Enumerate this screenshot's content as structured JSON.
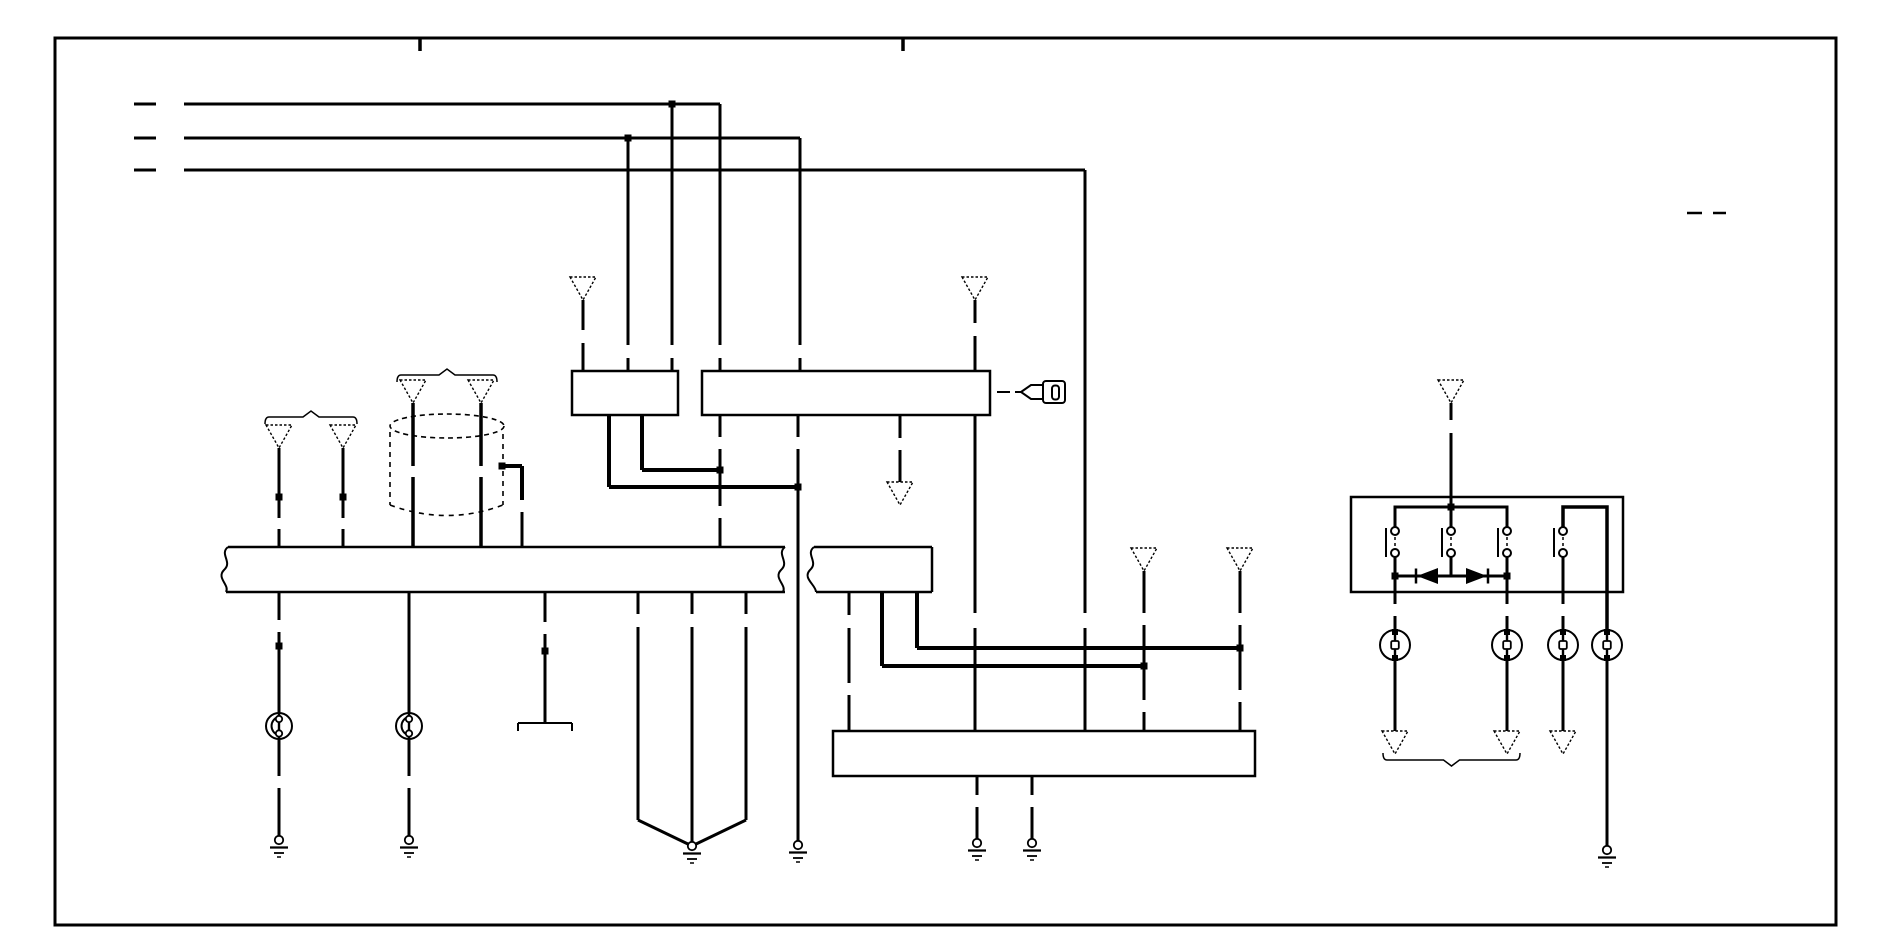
{
  "figure": {
    "kind": "automotive-wiring-diagram",
    "canvas": {
      "width": 1900,
      "height": 950
    },
    "colors": {
      "ink": "#000000",
      "paper": "#ffffff"
    },
    "border": {
      "x": 55,
      "y": 38,
      "w": 1781,
      "h": 887,
      "stroke": 3
    },
    "elements": [
      {
        "t": "l",
        "nm": "fold-tick",
        "x1": 420,
        "y1": 38,
        "x2": 420,
        "y2": 51,
        "w": 3.5
      },
      {
        "t": "l",
        "nm": "fold-tick",
        "x1": 903,
        "y1": 38,
        "x2": 903,
        "y2": 51,
        "w": 3.5
      },
      {
        "t": "l",
        "nm": "dash-mark",
        "x1": 1687,
        "y1": 213,
        "x2": 1702,
        "y2": 213,
        "w": 2.5
      },
      {
        "t": "l",
        "nm": "dash-mark",
        "x1": 1713,
        "y1": 213,
        "x2": 1726,
        "y2": 213,
        "w": 2.5
      },
      {
        "t": "l",
        "nm": "bus-1-lead",
        "x1": 134,
        "y1": 104,
        "x2": 156,
        "y2": 104
      },
      {
        "t": "l",
        "nm": "bus-1",
        "x1": 184,
        "y1": 104,
        "x2": 720,
        "y2": 104
      },
      {
        "t": "l",
        "x1": 720,
        "y1": 104,
        "x2": 720,
        "y2": 345
      },
      {
        "t": "l",
        "x1": 720,
        "y1": 358,
        "x2": 720,
        "y2": 371
      },
      {
        "t": "dot",
        "x": 672,
        "y": 104
      },
      {
        "t": "l",
        "x1": 672,
        "y1": 104,
        "x2": 672,
        "y2": 345
      },
      {
        "t": "l",
        "x1": 672,
        "y1": 358,
        "x2": 672,
        "y2": 371
      },
      {
        "t": "l",
        "nm": "bus-2-lead",
        "x1": 134,
        "y1": 138,
        "x2": 156,
        "y2": 138
      },
      {
        "t": "l",
        "nm": "bus-2",
        "x1": 184,
        "y1": 138,
        "x2": 800,
        "y2": 138
      },
      {
        "t": "l",
        "x1": 800,
        "y1": 138,
        "x2": 800,
        "y2": 345
      },
      {
        "t": "l",
        "x1": 800,
        "y1": 358,
        "x2": 800,
        "y2": 371
      },
      {
        "t": "dot",
        "x": 628,
        "y": 138
      },
      {
        "t": "l",
        "x1": 628,
        "y1": 138,
        "x2": 628,
        "y2": 345
      },
      {
        "t": "l",
        "x1": 628,
        "y1": 358,
        "x2": 628,
        "y2": 371
      },
      {
        "t": "l",
        "nm": "bus-3-lead",
        "x1": 134,
        "y1": 170,
        "x2": 156,
        "y2": 170
      },
      {
        "t": "l",
        "nm": "bus-3",
        "x1": 184,
        "y1": 170,
        "x2": 1085,
        "y2": 170
      },
      {
        "t": "l",
        "x1": 1085,
        "y1": 170,
        "x2": 1085,
        "y2": 613
      },
      {
        "t": "l",
        "x1": 1085,
        "y1": 628,
        "x2": 1085,
        "y2": 731
      },
      {
        "t": "tri",
        "x": 583,
        "y": 277
      },
      {
        "t": "l",
        "x1": 583,
        "y1": 300,
        "x2": 583,
        "y2": 330
      },
      {
        "t": "l",
        "x1": 583,
        "y1": 343,
        "x2": 583,
        "y2": 371
      },
      {
        "t": "tri",
        "x": 975,
        "y": 277
      },
      {
        "t": "l",
        "x1": 975,
        "y1": 300,
        "x2": 975,
        "y2": 323
      },
      {
        "t": "l",
        "x1": 975,
        "y1": 336,
        "x2": 975,
        "y2": 371
      },
      {
        "t": "rect",
        "nm": "component-box-a",
        "x": 572,
        "y": 371,
        "w": 106,
        "h": 44
      },
      {
        "t": "rect",
        "nm": "component-box-b",
        "x": 702,
        "y": 371,
        "w": 288,
        "h": 44
      },
      {
        "t": "l",
        "x1": 642,
        "y1": 415,
        "x2": 642,
        "y2": 470,
        "w": 4
      },
      {
        "t": "l",
        "x1": 642,
        "y1": 470,
        "x2": 720,
        "y2": 470,
        "w": 4
      },
      {
        "t": "dot",
        "x": 720,
        "y": 470
      },
      {
        "t": "l",
        "x1": 609,
        "y1": 415,
        "x2": 609,
        "y2": 487,
        "w": 4
      },
      {
        "t": "l",
        "x1": 609,
        "y1": 487,
        "x2": 798,
        "y2": 487,
        "w": 4
      },
      {
        "t": "dot",
        "x": 798,
        "y": 487
      },
      {
        "t": "l",
        "x1": 720,
        "y1": 415,
        "x2": 720,
        "y2": 437
      },
      {
        "t": "l",
        "x1": 720,
        "y1": 449,
        "x2": 720,
        "y2": 470
      },
      {
        "t": "l",
        "x1": 720,
        "y1": 470,
        "x2": 720,
        "y2": 506
      },
      {
        "t": "l",
        "x1": 720,
        "y1": 518,
        "x2": 720,
        "y2": 547
      },
      {
        "t": "l",
        "x1": 798,
        "y1": 415,
        "x2": 798,
        "y2": 437
      },
      {
        "t": "l",
        "x1": 798,
        "y1": 449,
        "x2": 798,
        "y2": 487
      },
      {
        "t": "l",
        "x1": 798,
        "y1": 487,
        "x2": 798,
        "y2": 841
      },
      {
        "t": "gnd",
        "x": 798,
        "y": 845
      },
      {
        "t": "l",
        "x1": 900,
        "y1": 415,
        "x2": 900,
        "y2": 438
      },
      {
        "t": "l",
        "x1": 900,
        "y1": 450,
        "x2": 900,
        "y2": 482
      },
      {
        "t": "tri",
        "x": 900,
        "y": 482
      },
      {
        "t": "l",
        "x1": 975,
        "y1": 415,
        "x2": 975,
        "y2": 613
      },
      {
        "t": "l",
        "x1": 975,
        "y1": 628,
        "x2": 975,
        "y2": 731
      },
      {
        "t": "key",
        "nm": "ignition-key-icon",
        "x": 997,
        "y": 392
      },
      {
        "t": "ell",
        "nm": "coil-ring",
        "x": 447,
        "y": 426,
        "rx": 57,
        "ry": 12
      },
      {
        "t": "l",
        "nm": "cylinder-side",
        "x1": 390,
        "y1": 432,
        "x2": 390,
        "y2": 505,
        "w": 1.6,
        "d": "5,5"
      },
      {
        "t": "l",
        "nm": "cylinder-side",
        "x1": 503,
        "y1": 434,
        "x2": 503,
        "y2": 461,
        "w": 1.6,
        "d": "5,5"
      },
      {
        "t": "l",
        "nm": "cylinder-side",
        "x1": 503,
        "y1": 471,
        "x2": 503,
        "y2": 505,
        "w": 1.6,
        "d": "5,5"
      },
      {
        "t": "p",
        "nm": "cylinder-bottom",
        "d": "M390,505 Q447,526 503,505",
        "w": 1.6,
        "dash": "5,5"
      },
      {
        "t": "dot",
        "x": 502,
        "y": 466
      },
      {
        "t": "l",
        "x1": 502,
        "y1": 466,
        "x2": 522,
        "y2": 466,
        "w": 4
      },
      {
        "t": "l",
        "x1": 522,
        "y1": 466,
        "x2": 522,
        "y2": 500,
        "w": 4
      },
      {
        "t": "l",
        "x1": 522,
        "y1": 512,
        "x2": 522,
        "y2": 547
      },
      {
        "t": "tri",
        "x": 413,
        "y": 380
      },
      {
        "t": "l",
        "x1": 413,
        "y1": 403,
        "x2": 413,
        "y2": 466,
        "w": 3.5
      },
      {
        "t": "l",
        "x1": 413,
        "y1": 477,
        "x2": 413,
        "y2": 547,
        "w": 3.5
      },
      {
        "t": "tri",
        "x": 481,
        "y": 380
      },
      {
        "t": "l",
        "x1": 481,
        "y1": 403,
        "x2": 481,
        "y2": 466,
        "w": 3.5
      },
      {
        "t": "l",
        "x1": 481,
        "y1": 477,
        "x2": 481,
        "y2": 547,
        "w": 3.5
      },
      {
        "t": "brace",
        "x1": 397,
        "x2": 497,
        "y": 375,
        "dir": "up"
      },
      {
        "t": "tri",
        "x": 279,
        "y": 425
      },
      {
        "t": "l",
        "x1": 279,
        "y1": 448,
        "x2": 279,
        "y2": 518
      },
      {
        "t": "dot",
        "x": 279,
        "y": 497
      },
      {
        "t": "l",
        "x1": 279,
        "y1": 529,
        "x2": 279,
        "y2": 547
      },
      {
        "t": "tri",
        "x": 343,
        "y": 425
      },
      {
        "t": "l",
        "x1": 343,
        "y1": 448,
        "x2": 343,
        "y2": 518
      },
      {
        "t": "dot",
        "x": 343,
        "y": 497
      },
      {
        "t": "l",
        "x1": 343,
        "y1": 529,
        "x2": 343,
        "y2": 547
      },
      {
        "t": "brace",
        "x1": 265,
        "x2": 357,
        "y": 417,
        "dir": "up"
      },
      {
        "t": "l",
        "nm": "bar-a-top",
        "x1": 228,
        "y1": 547,
        "x2": 785,
        "y2": 547,
        "w": 2.5
      },
      {
        "t": "l",
        "nm": "bar-a-bottom",
        "x1": 226,
        "y1": 592,
        "x2": 785,
        "y2": 592,
        "w": 2.5
      },
      {
        "t": "p",
        "nm": "bar-a-torn-left",
        "d": "M228,547 C219,554 233,562 224,570 C216,578 230,585 226,592",
        "w": 2
      },
      {
        "t": "p",
        "nm": "bar-a-torn-right",
        "d": "M785,547 C776,554 790,562 781,570 C773,578 787,585 783,592",
        "w": 2
      },
      {
        "t": "l",
        "x1": 279,
        "y1": 592,
        "x2": 279,
        "y2": 620
      },
      {
        "t": "l",
        "x1": 279,
        "y1": 632,
        "x2": 279,
        "y2": 713
      },
      {
        "t": "dot",
        "x": 279,
        "y": 646
      },
      {
        "t": "ca",
        "x": 279,
        "y": 726
      },
      {
        "t": "l",
        "x1": 279,
        "y1": 739,
        "x2": 279,
        "y2": 776
      },
      {
        "t": "l",
        "x1": 279,
        "y1": 788,
        "x2": 279,
        "y2": 836
      },
      {
        "t": "gnd",
        "x": 279,
        "y": 840
      },
      {
        "t": "l",
        "x1": 409,
        "y1": 592,
        "x2": 409,
        "y2": 713
      },
      {
        "t": "ca",
        "x": 409,
        "y": 726
      },
      {
        "t": "l",
        "x1": 409,
        "y1": 739,
        "x2": 409,
        "y2": 776
      },
      {
        "t": "l",
        "x1": 409,
        "y1": 788,
        "x2": 409,
        "y2": 836
      },
      {
        "t": "gnd",
        "x": 409,
        "y": 840
      },
      {
        "t": "l",
        "x1": 545,
        "y1": 592,
        "x2": 545,
        "y2": 622
      },
      {
        "t": "l",
        "x1": 545,
        "y1": 634,
        "x2": 545,
        "y2": 723
      },
      {
        "t": "dot",
        "x": 545,
        "y": 651
      },
      {
        "t": "l",
        "nm": "bracket-bar",
        "x1": 518,
        "y1": 723,
        "x2": 572,
        "y2": 723,
        "w": 2
      },
      {
        "t": "l",
        "nm": "bracket-tick",
        "x1": 518,
        "y1": 723,
        "x2": 518,
        "y2": 731,
        "w": 2
      },
      {
        "t": "l",
        "nm": "bracket-tick",
        "x1": 572,
        "y1": 723,
        "x2": 572,
        "y2": 731,
        "w": 2
      },
      {
        "t": "l",
        "x1": 638,
        "y1": 592,
        "x2": 638,
        "y2": 614
      },
      {
        "t": "l",
        "x1": 638,
        "y1": 627,
        "x2": 638,
        "y2": 820
      },
      {
        "t": "l",
        "x1": 638,
        "y1": 820,
        "x2": 690,
        "y2": 845
      },
      {
        "t": "l",
        "x1": 692,
        "y1": 592,
        "x2": 692,
        "y2": 614
      },
      {
        "t": "l",
        "x1": 692,
        "y1": 627,
        "x2": 692,
        "y2": 842
      },
      {
        "t": "l",
        "x1": 746,
        "y1": 592,
        "x2": 746,
        "y2": 614
      },
      {
        "t": "l",
        "x1": 746,
        "y1": 627,
        "x2": 746,
        "y2": 820
      },
      {
        "t": "l",
        "x1": 746,
        "y1": 820,
        "x2": 694,
        "y2": 845
      },
      {
        "t": "gnd",
        "x": 692,
        "y": 846
      },
      {
        "t": "l",
        "nm": "bar-b-top",
        "x1": 814,
        "y1": 547,
        "x2": 932,
        "y2": 547,
        "w": 2.5
      },
      {
        "t": "l",
        "nm": "bar-b-right",
        "x1": 932,
        "y1": 547,
        "x2": 932,
        "y2": 592,
        "w": 2.5
      },
      {
        "t": "l",
        "nm": "bar-b-bottom",
        "x1": 816,
        "y1": 592,
        "x2": 932,
        "y2": 592,
        "w": 2.5
      },
      {
        "t": "p",
        "nm": "bar-b-torn-left",
        "d": "M814,547 C805,554 819,562 810,570 C802,578 816,585 816,592",
        "w": 2
      },
      {
        "t": "l",
        "x1": 849,
        "y1": 592,
        "x2": 849,
        "y2": 615
      },
      {
        "t": "l",
        "x1": 849,
        "y1": 628,
        "x2": 849,
        "y2": 683
      },
      {
        "t": "l",
        "x1": 849,
        "y1": 695,
        "x2": 849,
        "y2": 731
      },
      {
        "t": "l",
        "x1": 882,
        "y1": 592,
        "x2": 882,
        "y2": 666,
        "w": 4
      },
      {
        "t": "l",
        "x1": 882,
        "y1": 666,
        "x2": 1144,
        "y2": 666,
        "w": 4
      },
      {
        "t": "dot",
        "x": 1144,
        "y": 666
      },
      {
        "t": "l",
        "x1": 917,
        "y1": 592,
        "x2": 917,
        "y2": 648,
        "w": 4
      },
      {
        "t": "l",
        "x1": 917,
        "y1": 648,
        "x2": 1240,
        "y2": 648,
        "w": 4
      },
      {
        "t": "dot",
        "x": 1240,
        "y": 648
      },
      {
        "t": "tri",
        "x": 1144,
        "y": 548
      },
      {
        "t": "l",
        "x1": 1144,
        "y1": 571,
        "x2": 1144,
        "y2": 613
      },
      {
        "t": "l",
        "x1": 1144,
        "y1": 625,
        "x2": 1144,
        "y2": 666
      },
      {
        "t": "l",
        "x1": 1144,
        "y1": 666,
        "x2": 1144,
        "y2": 700
      },
      {
        "t": "l",
        "x1": 1144,
        "y1": 712,
        "x2": 1144,
        "y2": 731
      },
      {
        "t": "tri",
        "x": 1240,
        "y": 548
      },
      {
        "t": "l",
        "x1": 1240,
        "y1": 571,
        "x2": 1240,
        "y2": 613
      },
      {
        "t": "l",
        "x1": 1240,
        "y1": 625,
        "x2": 1240,
        "y2": 648
      },
      {
        "t": "l",
        "x1": 1240,
        "y1": 648,
        "x2": 1240,
        "y2": 690
      },
      {
        "t": "l",
        "x1": 1240,
        "y1": 702,
        "x2": 1240,
        "y2": 731
      },
      {
        "t": "rect",
        "nm": "component-box-c",
        "x": 833,
        "y": 731,
        "w": 422,
        "h": 45
      },
      {
        "t": "l",
        "x1": 977,
        "y1": 776,
        "x2": 977,
        "y2": 795
      },
      {
        "t": "l",
        "x1": 977,
        "y1": 807,
        "x2": 977,
        "y2": 839
      },
      {
        "t": "gnd",
        "x": 977,
        "y": 843
      },
      {
        "t": "l",
        "x1": 1032,
        "y1": 776,
        "x2": 1032,
        "y2": 795
      },
      {
        "t": "l",
        "x1": 1032,
        "y1": 807,
        "x2": 1032,
        "y2": 839
      },
      {
        "t": "gnd",
        "x": 1032,
        "y": 843
      },
      {
        "t": "rect",
        "nm": "component-box-d",
        "x": 1351,
        "y": 497,
        "w": 272,
        "h": 95
      },
      {
        "t": "tri",
        "x": 1451,
        "y": 380
      },
      {
        "t": "l",
        "x1": 1451,
        "y1": 403,
        "x2": 1451,
        "y2": 420
      },
      {
        "t": "l",
        "x1": 1451,
        "y1": 433,
        "x2": 1451,
        "y2": 507
      },
      {
        "t": "dot",
        "x": 1451,
        "y": 507
      },
      {
        "t": "p",
        "nm": "switch-feed-bus",
        "d": "M1395,528 L1395,507 L1507,507 L1507,528",
        "w": 3
      },
      {
        "t": "l",
        "x1": 1451,
        "y1": 507,
        "x2": 1451,
        "y2": 528
      },
      {
        "t": "swc",
        "x": 1395,
        "y": 528
      },
      {
        "t": "swc",
        "x": 1451,
        "y": 528
      },
      {
        "t": "swc",
        "x": 1507,
        "y": 528
      },
      {
        "t": "swc",
        "x": 1563,
        "y": 528
      },
      {
        "t": "l",
        "x1": 1395,
        "y1": 557,
        "x2": 1395,
        "y2": 576
      },
      {
        "t": "l",
        "x1": 1451,
        "y1": 557,
        "x2": 1451,
        "y2": 576
      },
      {
        "t": "l",
        "x1": 1507,
        "y1": 557,
        "x2": 1507,
        "y2": 576
      },
      {
        "t": "l",
        "nm": "diode-bus",
        "x1": 1395,
        "y1": 576,
        "x2": 1507,
        "y2": 576,
        "w": 3
      },
      {
        "t": "dot",
        "x": 1395,
        "y": 576
      },
      {
        "t": "dot",
        "x": 1507,
        "y": 576
      },
      {
        "t": "diode",
        "x": 1427,
        "y": 576,
        "dir": "left"
      },
      {
        "t": "diode",
        "x": 1477,
        "y": 576,
        "dir": "right"
      },
      {
        "t": "p",
        "nm": "switch4-feed",
        "d": "M1563,528 L1563,507 L1607,507 L1607,592",
        "w": 3.5
      },
      {
        "t": "l",
        "x1": 1395,
        "y1": 576,
        "x2": 1395,
        "y2": 604
      },
      {
        "t": "l",
        "x1": 1395,
        "y1": 616,
        "x2": 1395,
        "y2": 630
      },
      {
        "t": "cb",
        "x": 1395,
        "y": 645
      },
      {
        "t": "l",
        "x1": 1395,
        "y1": 660,
        "x2": 1395,
        "y2": 731
      },
      {
        "t": "tri",
        "x": 1395,
        "y": 731
      },
      {
        "t": "l",
        "x1": 1507,
        "y1": 576,
        "x2": 1507,
        "y2": 604
      },
      {
        "t": "l",
        "x1": 1507,
        "y1": 616,
        "x2": 1507,
        "y2": 630
      },
      {
        "t": "cb",
        "x": 1507,
        "y": 645
      },
      {
        "t": "l",
        "x1": 1507,
        "y1": 660,
        "x2": 1507,
        "y2": 731
      },
      {
        "t": "tri",
        "x": 1507,
        "y": 731
      },
      {
        "t": "l",
        "x1": 1563,
        "y1": 557,
        "x2": 1563,
        "y2": 604
      },
      {
        "t": "l",
        "x1": 1563,
        "y1": 616,
        "x2": 1563,
        "y2": 630
      },
      {
        "t": "cb",
        "x": 1563,
        "y": 645
      },
      {
        "t": "l",
        "x1": 1563,
        "y1": 660,
        "x2": 1563,
        "y2": 731
      },
      {
        "t": "tri",
        "x": 1563,
        "y": 731
      },
      {
        "t": "l",
        "x1": 1607,
        "y1": 592,
        "x2": 1607,
        "y2": 630,
        "w": 3.5
      },
      {
        "t": "cb",
        "x": 1607,
        "y": 645
      },
      {
        "t": "l",
        "x1": 1607,
        "y1": 660,
        "x2": 1607,
        "y2": 846
      },
      {
        "t": "gnd",
        "x": 1607,
        "y": 850
      },
      {
        "t": "brace",
        "x1": 1383,
        "x2": 1520,
        "y": 760,
        "dir": "down"
      }
    ]
  }
}
